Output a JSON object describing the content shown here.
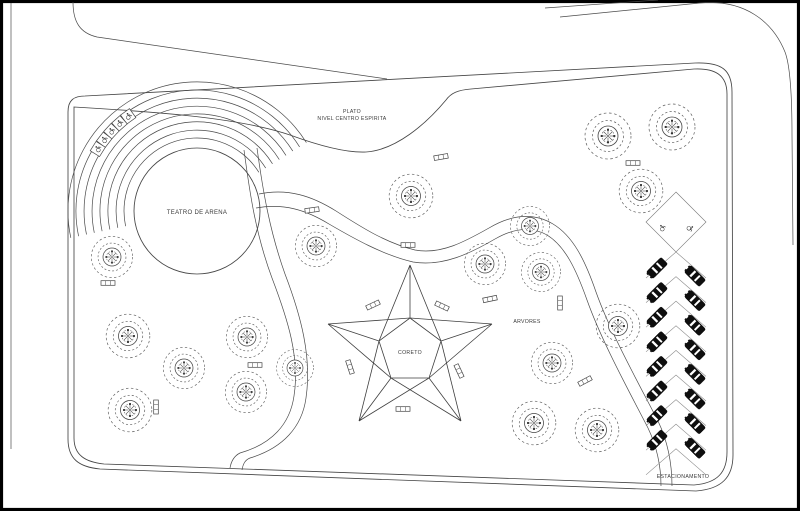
{
  "labels": {
    "plateau_line1": "PLATO",
    "plateau_line2": "NIVEL CENTRO ESPIRITA",
    "theater": "TEATRO DE ARENA",
    "bandstand": "CORETO",
    "trees_area": "ARVORES",
    "parking": "ESTACIONAMENTO"
  },
  "colors": {
    "line": "#4a4a4a",
    "text": "#3a3a3a",
    "car_fill": "#0e0e0e",
    "frame": "#000000",
    "background": "#ffffff"
  },
  "trees": [
    [
      608,
      136,
      1.0
    ],
    [
      672,
      127,
      1.0
    ],
    [
      641,
      191,
      0.95
    ],
    [
      411,
      196,
      0.95
    ],
    [
      530,
      226,
      0.85
    ],
    [
      485,
      264,
      0.9
    ],
    [
      541,
      272,
      0.85
    ],
    [
      316,
      246,
      0.9
    ],
    [
      618,
      326,
      0.95
    ],
    [
      552,
      363,
      0.9
    ],
    [
      534,
      423,
      0.95
    ],
    [
      597,
      430,
      0.95
    ],
    [
      112,
      257,
      0.9
    ],
    [
      128,
      336,
      0.95
    ],
    [
      184,
      368,
      0.9
    ],
    [
      247,
      337,
      0.9
    ],
    [
      246,
      392,
      0.9
    ],
    [
      130,
      410,
      0.95
    ],
    [
      295,
      368,
      0.8
    ]
  ],
  "benches": [
    [
      312,
      210,
      -8
    ],
    [
      408,
      245,
      0
    ],
    [
      441,
      157,
      -10
    ],
    [
      633,
      163,
      0
    ],
    [
      373,
      305,
      -25
    ],
    [
      442,
      306,
      25
    ],
    [
      350,
      367,
      72
    ],
    [
      459,
      371,
      65
    ],
    [
      403,
      409,
      0
    ],
    [
      585,
      381,
      -28
    ],
    [
      560,
      303,
      90
    ],
    [
      108,
      283,
      0
    ],
    [
      156,
      407,
      90
    ],
    [
      255,
      365,
      0
    ],
    [
      490,
      299,
      -12
    ]
  ],
  "parking": {
    "left_cars": 8,
    "right_cars": 8,
    "row_start": 268,
    "row_pitch": 24.6,
    "left_x": 657,
    "right_x": 695,
    "right_offset": 8,
    "chevron_rows": 9,
    "chevron_start": 252,
    "accessible_stalls": 2
  },
  "amphitheater": {
    "arc_count": 8,
    "inner_radius": 73,
    "radius_step": 8,
    "center_x": 197,
    "center_y": 211,
    "circle_radius": 63,
    "seat_count": 5,
    "seat_radius": 117,
    "seat_angles": [
      126,
      131.5,
      137,
      142.5,
      148
    ]
  }
}
